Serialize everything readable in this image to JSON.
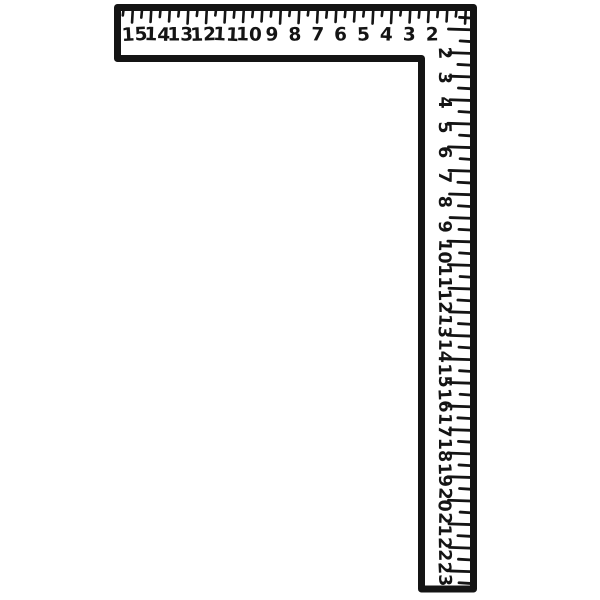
{
  "colors": {
    "ink": "#141414",
    "paper": "#ffffff"
  },
  "illustration": {
    "object": "framing-square",
    "horizontal_scale": {
      "labels": [
        "15",
        "14",
        "13",
        "12",
        "11",
        "10",
        "9",
        "8",
        "7",
        "6",
        "5",
        "4",
        "3",
        "2"
      ]
    },
    "vertical_scale": {
      "labels": [
        "2",
        "3",
        "4",
        "5",
        "6",
        "7",
        "8",
        "9",
        "10",
        "11",
        "12",
        "13",
        "14",
        "15",
        "16",
        "17",
        "18",
        "19",
        "20",
        "21",
        "22",
        "23"
      ]
    }
  }
}
